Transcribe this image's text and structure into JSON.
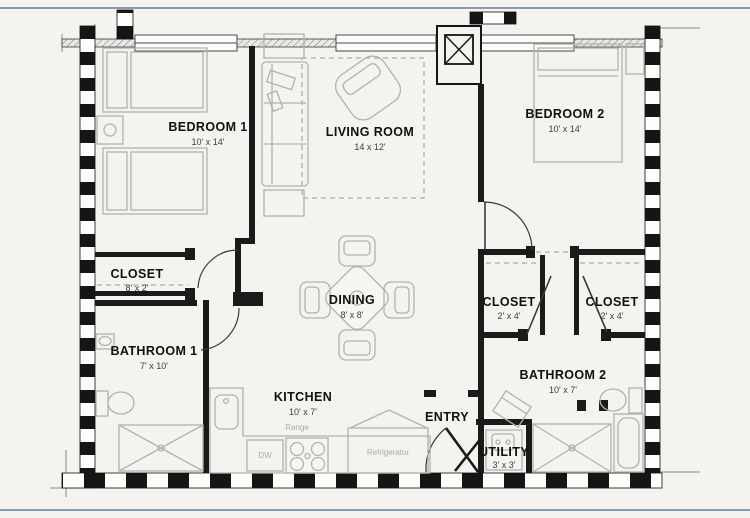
{
  "page": {
    "background": "#f4f3f0",
    "border_color": "#8b9bb1"
  },
  "plan": {
    "rooms": [
      {
        "id": "bedroom-1",
        "name": "BEDROOM 1",
        "dims": "10' x 14'"
      },
      {
        "id": "living-room",
        "name": "LIVING ROOM",
        "dims": "14 x 12'"
      },
      {
        "id": "bedroom-2",
        "name": "BEDROOM 2",
        "dims": "10' x 14'"
      },
      {
        "id": "closet-left",
        "name": "CLOSET",
        "dims": "8' x 2'"
      },
      {
        "id": "dining",
        "name": "DINING",
        "dims": "8' x 8'"
      },
      {
        "id": "closet-right-1",
        "name": "CLOSET",
        "dims": "2' x 4'"
      },
      {
        "id": "closet-right-2",
        "name": "CLOSET",
        "dims": "2' x 4'"
      },
      {
        "id": "bathroom-1",
        "name": "BATHROOM 1",
        "dims": "7' x 10'"
      },
      {
        "id": "bathroom-2",
        "name": "BATHROOM 2",
        "dims": "10' x 7'"
      },
      {
        "id": "kitchen",
        "name": "KITCHEN",
        "dims": "10' x 7'"
      },
      {
        "id": "entry",
        "name": "ENTRY",
        "dims": ""
      },
      {
        "id": "utility",
        "name": "UTILITY",
        "dims": "3' x 3'"
      }
    ],
    "appliances": {
      "range": "Range",
      "dishwasher": "DW",
      "refrigerator": "Refrigerator"
    },
    "colors": {
      "wall": "#1a1a1a",
      "furniture": "#b2b2ac",
      "room_label": "#101010",
      "dim_label": "#3c3c3c",
      "appliance_label": "#ababa3"
    }
  }
}
